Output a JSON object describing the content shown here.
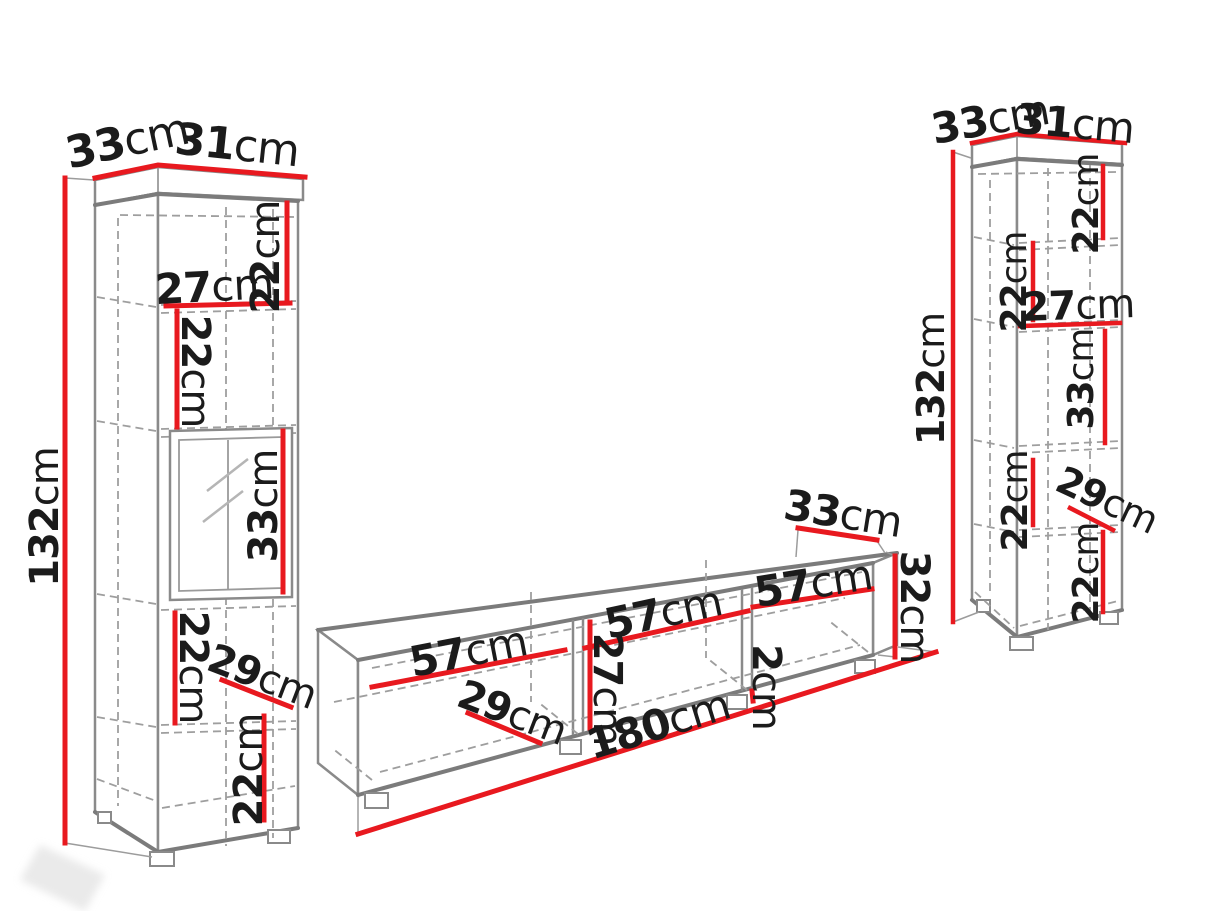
{
  "diagram_title": "TV wall unit set dimension diagram",
  "colors": {
    "dimension_line": "#e8191f",
    "furniture_edge": "#8a8a8a",
    "hidden_edge_dashed": "#9e9e9e",
    "label_text": "#1b1b1b",
    "background": "#ffffff"
  },
  "left_cabinet": {
    "name": "left tall display cabinet",
    "top_depth": {
      "num": "33",
      "unit": "cm"
    },
    "top_width": {
      "num": "31",
      "unit": "cm"
    },
    "height": {
      "num": "132",
      "unit": "cm"
    },
    "sec1_height": {
      "num": "22",
      "unit": "cm"
    },
    "inner_width": {
      "num": "27",
      "unit": "cm"
    },
    "sec2_height": {
      "num": "22",
      "unit": "cm"
    },
    "glass_sec_height": {
      "num": "33",
      "unit": "cm"
    },
    "sec4_height": {
      "num": "22",
      "unit": "cm"
    },
    "inner_depth": {
      "num": "29",
      "unit": "cm"
    },
    "sec5_height": {
      "num": "22",
      "unit": "cm"
    }
  },
  "tv_stand": {
    "name": "TV stand 180cm",
    "depth": {
      "num": "33",
      "unit": "cm"
    },
    "height": {
      "num": "32",
      "unit": "cm"
    },
    "comp1_width": {
      "num": "57",
      "unit": "cm"
    },
    "comp2_width": {
      "num": "57",
      "unit": "cm"
    },
    "comp3_width": {
      "num": "57",
      "unit": "cm"
    },
    "inner_height": {
      "num": "27",
      "unit": "cm"
    },
    "inner_depth": {
      "num": "29",
      "unit": "cm"
    },
    "panel_gap": {
      "num": "2",
      "unit": "cm"
    },
    "total_width": {
      "num": "180",
      "unit": "cm"
    }
  },
  "right_cabinet": {
    "name": "right tall display cabinet",
    "top_depth": {
      "num": "33",
      "unit": "cm"
    },
    "top_width": {
      "num": "31",
      "unit": "cm"
    },
    "height": {
      "num": "132",
      "unit": "cm"
    },
    "sec1_height": {
      "num": "22",
      "unit": "cm"
    },
    "sec2_height": {
      "num": "22",
      "unit": "cm"
    },
    "inner_width": {
      "num": "27",
      "unit": "cm"
    },
    "mid_sec_height": {
      "num": "33",
      "unit": "cm"
    },
    "sec4_height": {
      "num": "22",
      "unit": "cm"
    },
    "inner_depth": {
      "num": "29",
      "unit": "cm"
    },
    "sec5_height": {
      "num": "22",
      "unit": "cm"
    }
  }
}
